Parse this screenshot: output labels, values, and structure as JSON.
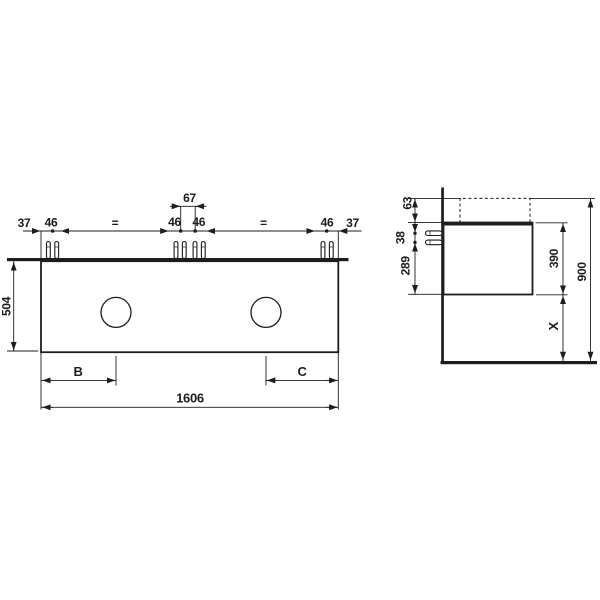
{
  "meta": {
    "description": "Technical dimension drawing of a wall-mounted double vanity unit, front view and side view",
    "colors": {
      "line": "#1d1d1b",
      "background": "#ffffff"
    }
  },
  "front_view": {
    "offset_left": "37",
    "screw_pair_left": "46",
    "equal_left": "=",
    "screw_pair_center_left": "46",
    "faucet_hole_spacing": "67",
    "screw_pair_center_right": "46",
    "equal_right": "=",
    "screw_pair_right": "46",
    "offset_right": "37",
    "cabinet_height": "504",
    "basin_offset_left": "B",
    "basin_offset_right": "C",
    "total_width": "1606"
  },
  "side_view": {
    "top_clearance": "63",
    "screw_spacing": "38",
    "lower_clearance": "289",
    "cabinet_depth_height": "390",
    "mounting_height": "900",
    "distance_below": "X"
  }
}
